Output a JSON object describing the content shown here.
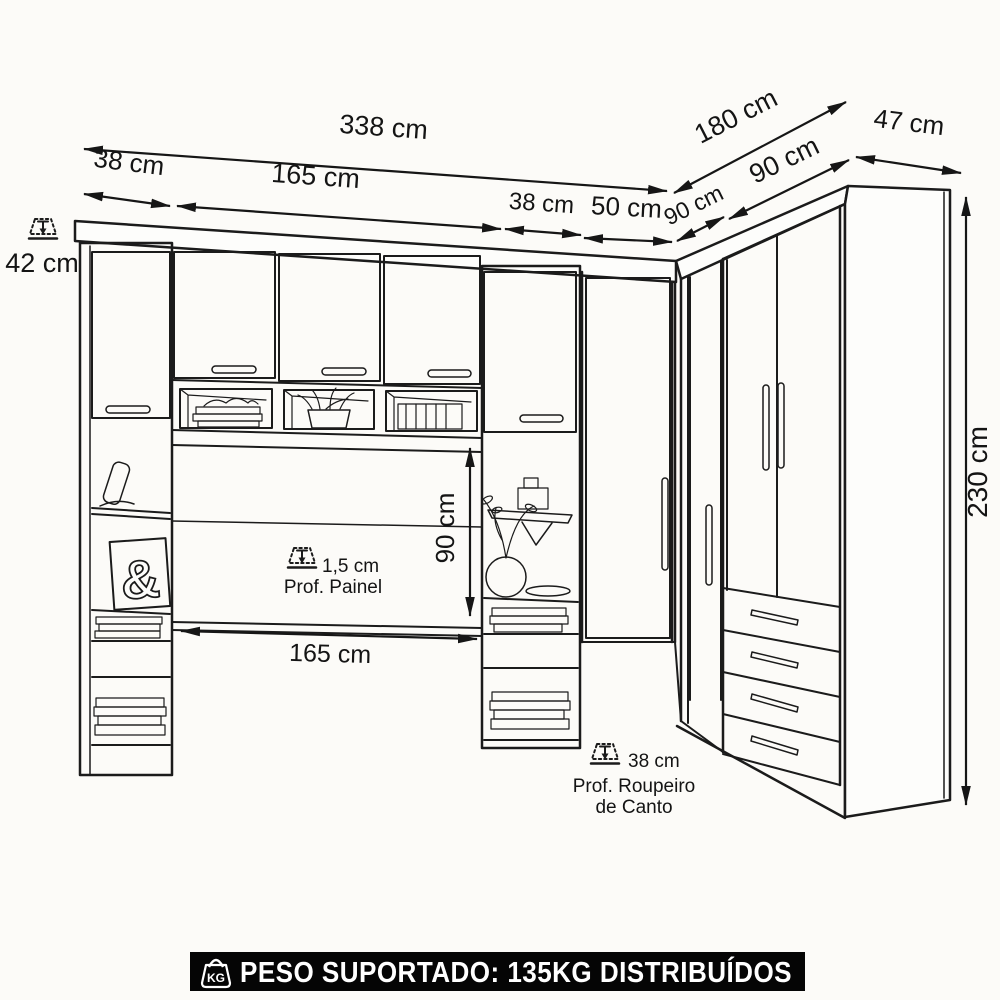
{
  "colors": {
    "ink": "#1b1b1b",
    "background": "#fcfbf8",
    "footer_bg": "#050505",
    "footer_fg": "#ffffff"
  },
  "dimensions": {
    "top_total": "338 cm",
    "tower_left_width": "38 cm",
    "bridge_top_span": "165 cm",
    "tower_right_width": "38 cm",
    "corner_door_width": "50 cm",
    "corner_angle_width": "90 cm",
    "right_wardrobe_width": "90 cm",
    "right_run_total": "180 cm",
    "side_depth": "47 cm",
    "hutch_depth": "42 cm",
    "total_height": "230 cm",
    "under_bridge_height": "90 cm",
    "bridge_inner_span": "165 cm"
  },
  "notes": {
    "panel_depth_value": "1,5 cm",
    "panel_depth_label": "Prof. Painel",
    "corner_depth_value": "38 cm",
    "corner_depth_label_line1": "Prof. Roupeiro",
    "corner_depth_label_line2": "de Canto"
  },
  "decor": {
    "ampersand": "&"
  },
  "footer": {
    "label": "PESO SUPORTADO: 135KG DISTRIBUÍDOS",
    "icon_text": "KG"
  }
}
